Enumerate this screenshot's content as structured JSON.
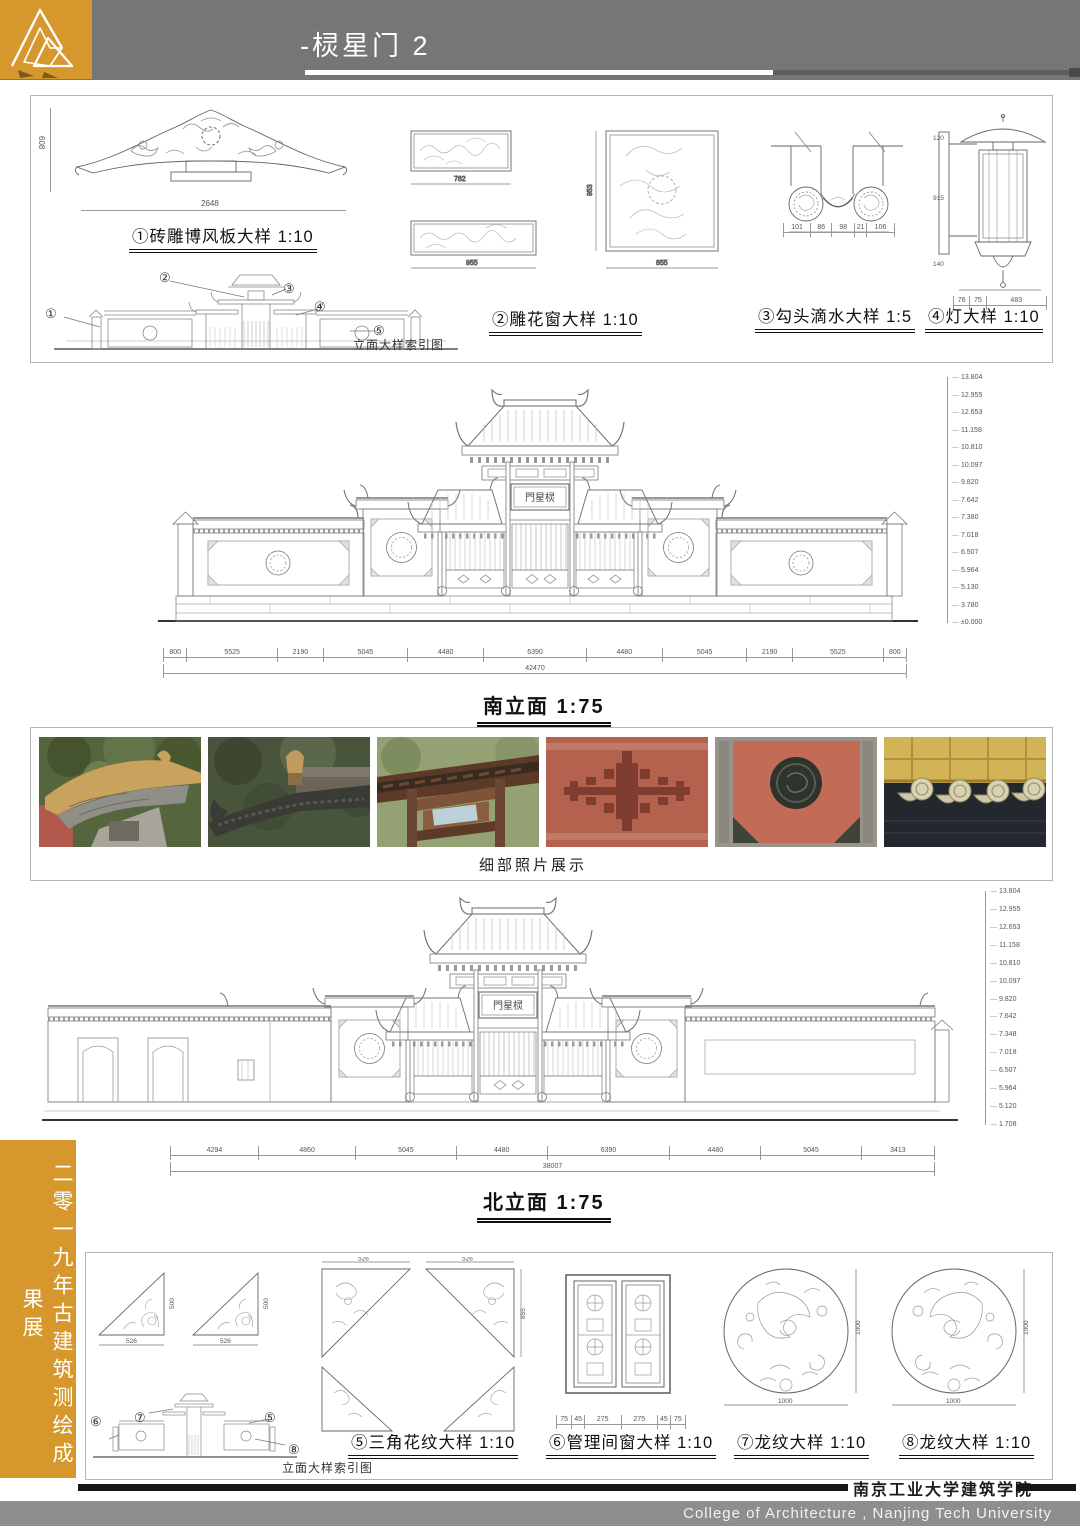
{
  "header": {
    "title": "-棂星门 2"
  },
  "colors": {
    "gold": "#D6982D",
    "header_gray": "#767676",
    "footer_gray": "#8E8E8E",
    "ink": "#111111"
  },
  "plaque": "門星棂",
  "top_panel": {
    "label1": "①砖雕博风板大样 1:10",
    "label2": "②雕花窗大样 1:10",
    "label3": "③勾头滴水大样 1:5",
    "label4": "④灯大样 1:10",
    "index_caption": "立面大样索引图",
    "callouts": [
      "①",
      "②",
      "③",
      "④",
      "⑤"
    ],
    "dims": {
      "bargeboard_w": "2648",
      "bargeboard_h": "608",
      "win1_w": "782",
      "win2_w": "955",
      "win3_w": "855",
      "win3_h": "953",
      "tile_bottom": [
        "101",
        "86",
        "98",
        "21",
        "106"
      ],
      "lamp_h": [
        "120",
        "915",
        "140"
      ],
      "lamp_w": [
        "76",
        "75",
        "483"
      ]
    }
  },
  "south": {
    "label": "南立面 1:75",
    "total": "42470",
    "segments": [
      "800",
      "5525",
      "2190",
      "5045",
      "4480",
      "6390",
      "4480",
      "5045",
      "2190",
      "5525",
      "800"
    ],
    "levels": [
      "13.804",
      "12.955",
      "12.653",
      "11.158",
      "10.810",
      "10.097",
      "9.820",
      "7.642",
      "7.380",
      "7.018",
      "6.507",
      "5.964",
      "5.130",
      "3.780",
      "±0.000"
    ]
  },
  "photos": {
    "caption": "细部照片展示",
    "items": [
      "roof-corner-carving",
      "upturned-eave-ridge",
      "gate-timber-brackets",
      "brick-relief-pattern",
      "wall-medallion-panel",
      "glazed-tile-eaves"
    ]
  },
  "north": {
    "label": "北立面 1:75",
    "total": "38007",
    "segments": [
      "4294",
      "4860",
      "5045",
      "4480",
      "6390",
      "4480",
      "5045",
      "3413"
    ],
    "levels": [
      "13.804",
      "12.955",
      "12.653",
      "11.158",
      "10.810",
      "10.097",
      "9.820",
      "7.642",
      "7.348",
      "7.018",
      "6.507",
      "5.964",
      "5.120",
      "1.708"
    ]
  },
  "bottom_panel": {
    "label5": "⑤三角花纹大样 1:10",
    "label6": "⑥管理间窗大样 1:10",
    "label7": "⑦龙纹大样 1:10",
    "label8": "⑧龙纹大样 1:10",
    "index_caption": "立面大样索引图",
    "callouts": [
      "⑥",
      "⑦",
      "⑤",
      "⑧"
    ],
    "dims": {
      "tri_w": "526",
      "tri_h": "500",
      "tri_w2": "526",
      "tri_h2": "855",
      "circle_d": "1000",
      "circle_h": "1000",
      "win_w": [
        "75",
        "45",
        "275",
        "275",
        "45",
        "75"
      ]
    }
  },
  "banner": {
    "text": "二零一九年古建筑测绘成果展"
  },
  "footer": {
    "cn": "南京工业大学建筑学院",
    "en": "College of Architecture , Nanjing Tech  University"
  }
}
